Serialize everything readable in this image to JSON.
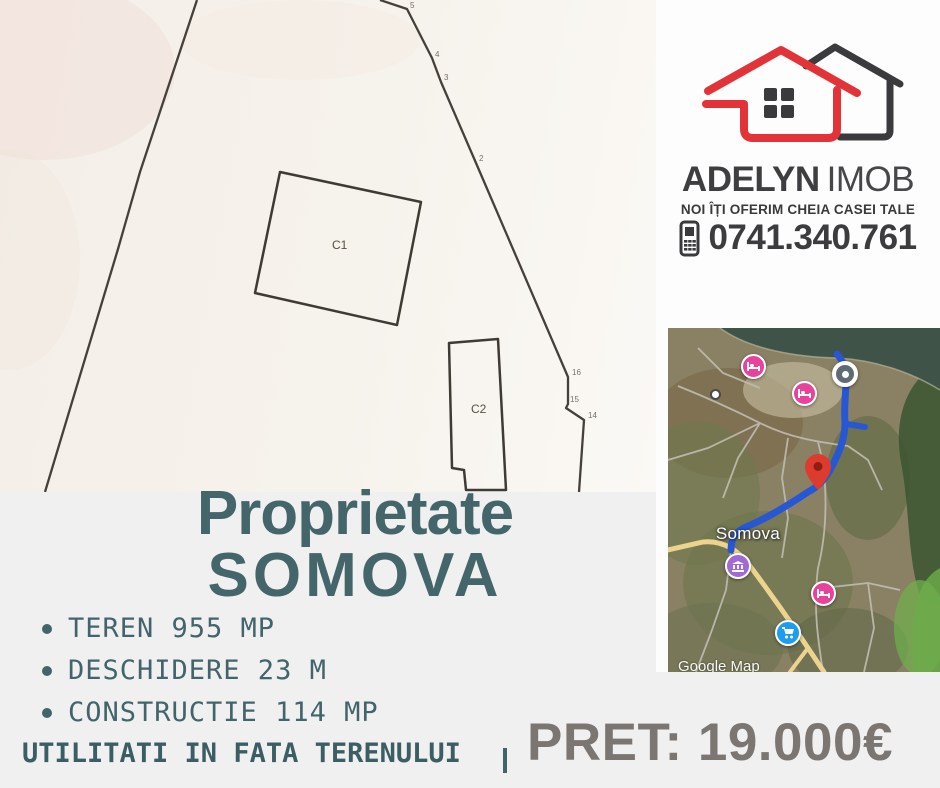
{
  "agency": {
    "name_primary": "ADELYN",
    "name_secondary": "IMOB",
    "tagline": "NOI ÎȚI OFERIM CHEIA CASEI TALE",
    "phone": "0741.340.761"
  },
  "listing": {
    "title_line1": "Proprietate",
    "title_line2": "SOMOVA",
    "features": [
      "TEREN 955 MP",
      "DESCHIDERE 23 M",
      "CONSTRUCTIE 114 MP"
    ],
    "utilities_note": "UTILITATI IN FATA TERENULUI",
    "price_label": "PRET: 19.000€"
  },
  "plan": {
    "building1_label": "C1",
    "building2_label": "C2",
    "vertex_labels": [
      "5",
      "4",
      "3",
      "2",
      "16",
      "15",
      "14"
    ]
  },
  "map": {
    "place_label": "Somova",
    "watermark": "Google Map"
  },
  "colors": {
    "teal_text": "#44666b",
    "price_gray": "#7b7672",
    "logo_red": "#e23438",
    "logo_dark": "#3b3b3d",
    "route_blue": "#2857d4",
    "hotel_pink": "#e8429c",
    "museum_purple": "#a168d6",
    "shop_blue": "#1b9df0",
    "panel_gray": "#f0f0f1"
  }
}
